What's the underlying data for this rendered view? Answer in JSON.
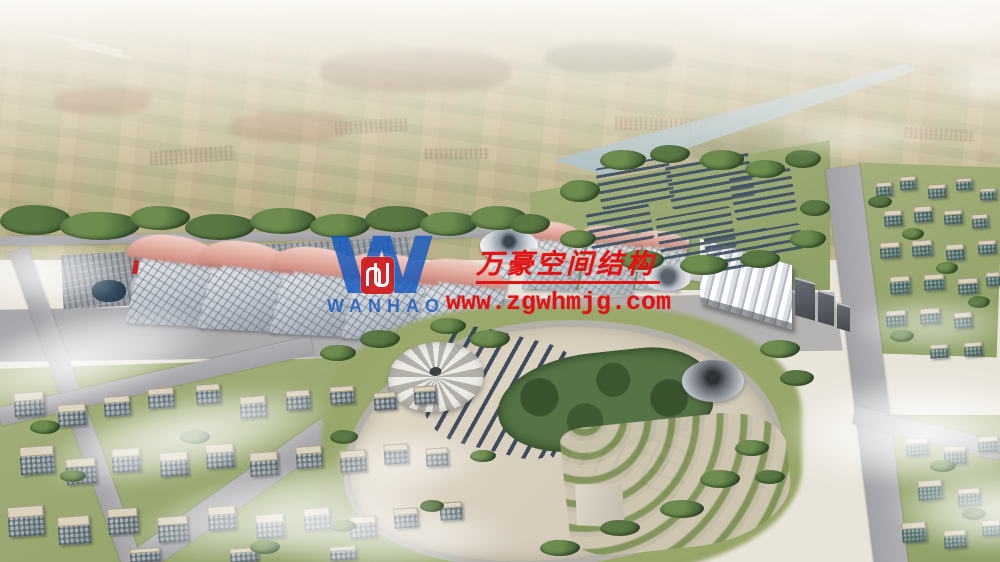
{
  "watermark": {
    "logo_initial": "W",
    "logo_text": "WANHAO",
    "logo_mark": "wanhao-red-monogram",
    "company_name_cn": "万豪空间结构",
    "website": "www.zgwhmjg.com",
    "text_red": "#e01212",
    "logo_blue": "#1a58be",
    "mark_red": "#d32020"
  },
  "palette": {
    "haze_white": "#f2ede4",
    "farmland_tan": "#c9bd9d",
    "canal_blue": "#b7cfdc",
    "hall_roof_gray": "#dfe3e8",
    "roof_wave_pink": "#dba69b",
    "solar_panel_navy": "#3d4f63",
    "plaza_beige": "#d8cfbf",
    "lawn_green": "#9aa86e",
    "forest_green": "#4a6b3a",
    "road_gray": "#a7a7ab"
  }
}
